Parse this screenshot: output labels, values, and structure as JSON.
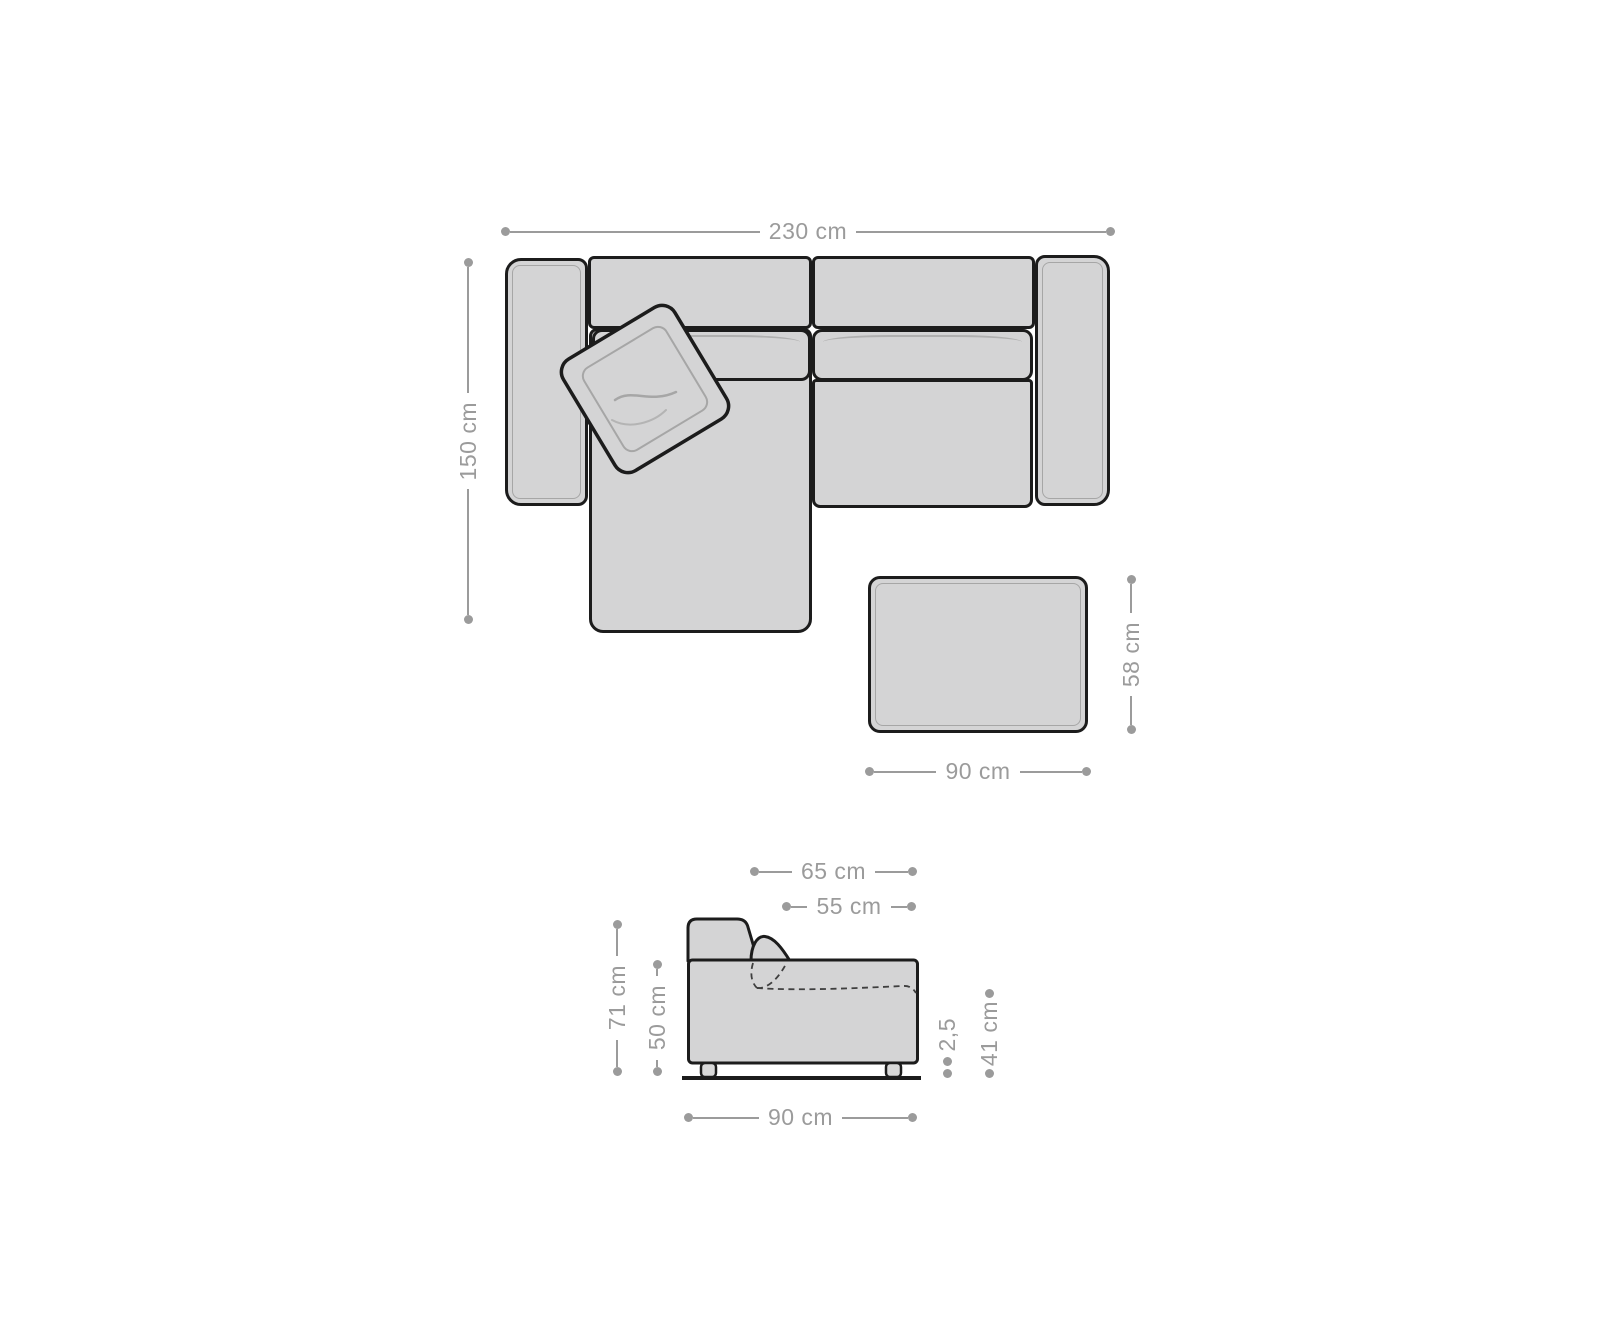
{
  "palette": {
    "background": "#ffffff",
    "upholstery_fill": "#d4d4d5",
    "outline": "#1c1c1c",
    "dimension_color": "#9b9b9b",
    "inner_seam_color": "#a6a6a6"
  },
  "top_view": {
    "width_label": "230 cm",
    "depth_label": "150 cm"
  },
  "ottoman": {
    "width_label": "90 cm",
    "height_label": "58 cm"
  },
  "side_view": {
    "depth_top_label": "65 cm",
    "seat_depth_label": "55 cm",
    "overall_height_label": "71 cm",
    "body_height_label": "50 cm",
    "leg_height_label": "2,5",
    "seat_height_label": "41 cm",
    "overall_depth_label": "90 cm"
  }
}
